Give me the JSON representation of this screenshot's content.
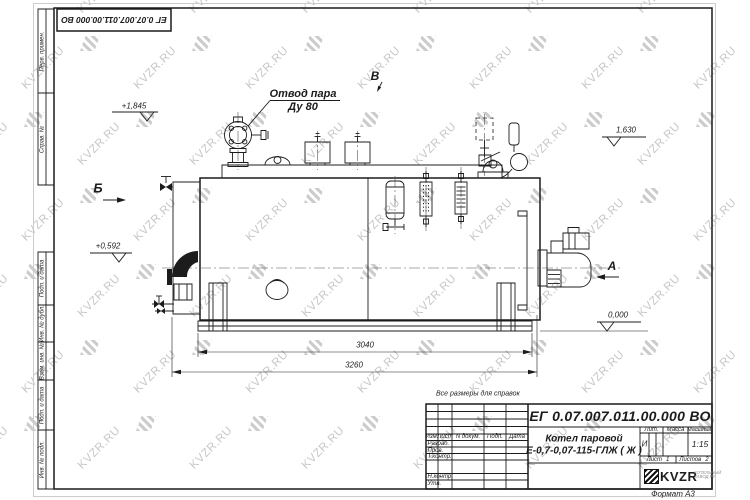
{
  "watermark": {
    "text": "KVZR.RU"
  },
  "colors": {
    "line": "#1c1c1c",
    "watermark": "#c7c7c7"
  },
  "stamp_top": {
    "doc_number": "ЕГ 0.07.007.011.00.000  ВО"
  },
  "margin": {
    "top": [
      "Перв. примен.",
      "Справ. №"
    ],
    "bottom": [
      "Подп. и дата",
      "Инв. № дубл.",
      "Взам. инв. №",
      "Подп. и дата",
      "Инв. № подл."
    ]
  },
  "drawing": {
    "callout": {
      "line1": "Отвод пара",
      "line2": "Ду 80"
    },
    "views": {
      "b": "Б",
      "v": "В",
      "a": "А"
    },
    "elevations": {
      "e1": "+1,845",
      "e2": "1,630",
      "e3": "+0,592",
      "e4": "0,000"
    },
    "dimensions": {
      "d1": "3040",
      "d2": "3260"
    },
    "note": "Все размеры для справок"
  },
  "title_block": {
    "doc_number": "ЕГ 0.07.007.011.00.000  ВО",
    "product": {
      "line1": "Котел паровой",
      "line2": "Е-0,7-0,07-115-ГЛЖ ( Ж )"
    },
    "columns": {
      "izm": "Изм.",
      "list": "Лист",
      "doc": "N докум.",
      "podp": "Подп.",
      "data": "Дата"
    },
    "sign_rows": [
      "Разраб.",
      "Пров.",
      "Т.контр.",
      "Н.контр.",
      "Утв."
    ],
    "lit": {
      "label": "Лит.",
      "value": "И"
    },
    "mass": {
      "label": "Масса"
    },
    "scale": {
      "label": "Масштаб",
      "value": "1:15"
    },
    "sheet": {
      "label": "Лист",
      "value": "1"
    },
    "sheets": {
      "label": "Листов",
      "value": "2"
    },
    "logo": {
      "text": "KVZR",
      "sub1": "КОТЕЛЬНЫЙ",
      "sub2": "ЗАВОД.РУ"
    },
    "format": "Формат А3"
  }
}
